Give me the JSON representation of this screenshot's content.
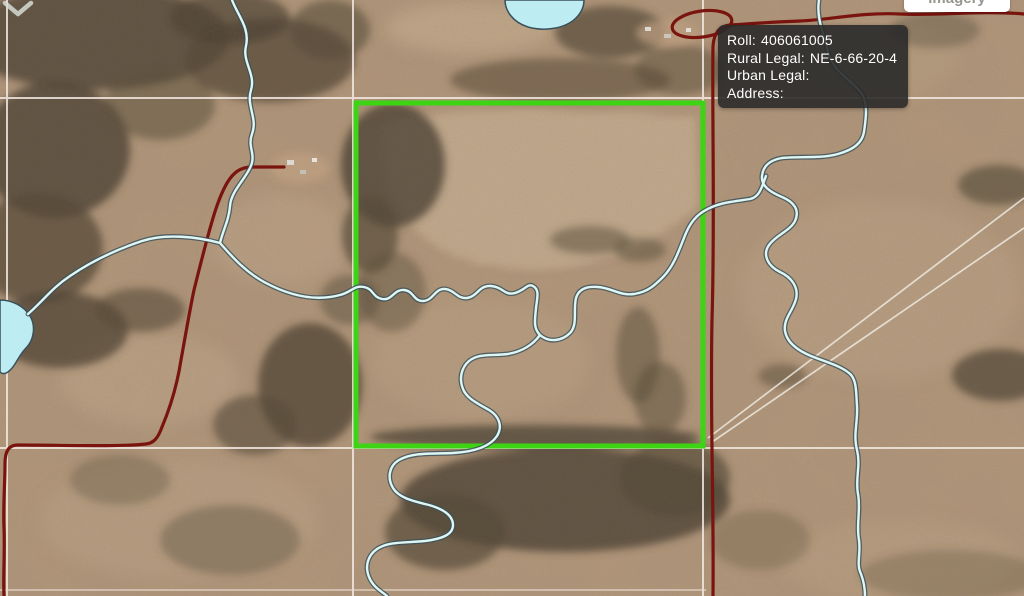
{
  "map_tooltip": {
    "fields": [
      {
        "label": "Roll:",
        "value": "406061005"
      },
      {
        "label": "Rural Legal:",
        "value": "NE-6-66-20-4"
      },
      {
        "label": "Urban Legal:",
        "value": ""
      },
      {
        "label": "Address:",
        "value": ""
      }
    ]
  },
  "basemap_control": {
    "label": "Imagery"
  },
  "selected_parcel": {
    "roll": "406061005",
    "rural_legal": "NE-6-66-20-4",
    "highlight_color": "#3CD413"
  },
  "map_colors": {
    "land": "#B3977B",
    "forest": "#4D4232",
    "water_fill": "#BDEDF2",
    "water_line": "#DFF7F4",
    "road": "#7A140E",
    "section_grid": "#F2E8E2",
    "tooltip_background": "#2A2A2A"
  }
}
